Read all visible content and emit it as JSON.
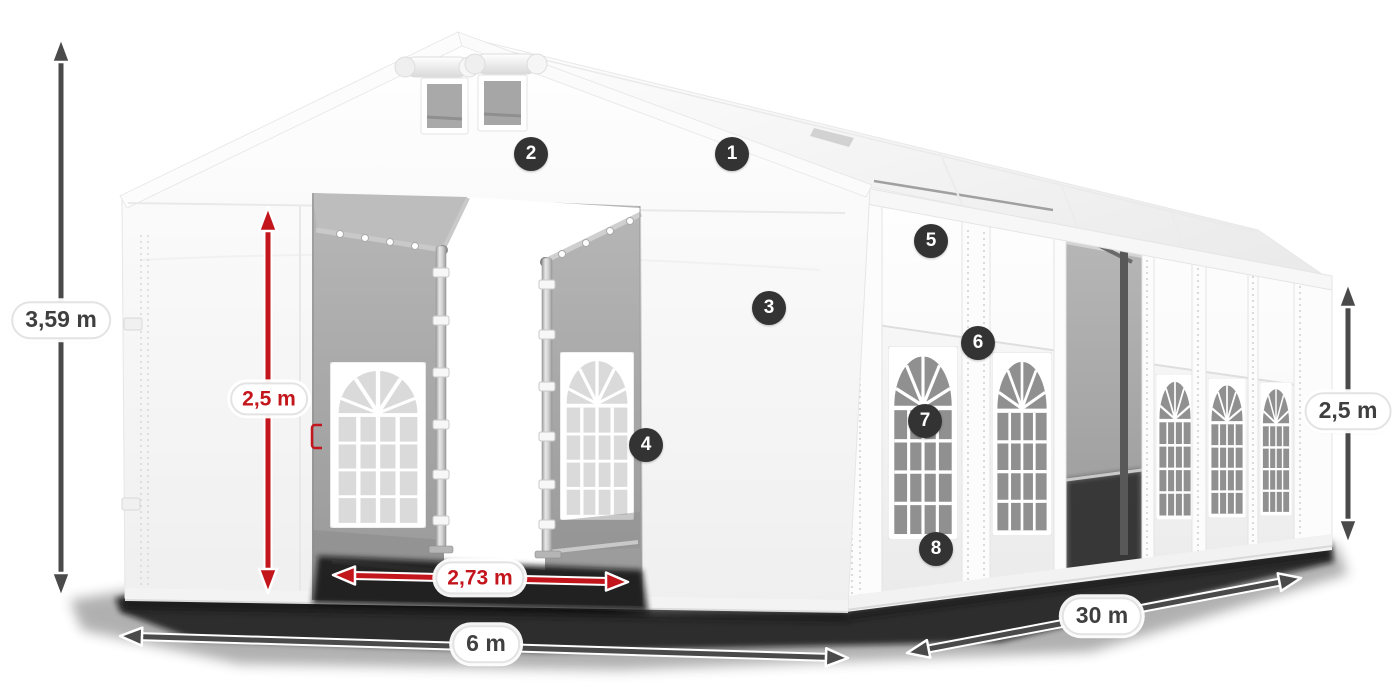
{
  "diagram": {
    "dimensions": {
      "total_height": "3,59 m",
      "entrance_height": "2,5 m",
      "entrance_width": "2,73 m",
      "width": "6 m",
      "length": "30 m",
      "side_wall_height": "2,5 m"
    },
    "feature_badges": [
      "1",
      "2",
      "3",
      "4",
      "5",
      "6",
      "7",
      "8"
    ],
    "colors": {
      "dimension_accent_red": "#c3151c",
      "dimension_arrow_gray": "#4a4a4a",
      "badge_background": "#333333",
      "badge_text": "#ffffff",
      "label_text": "#3f3f3f",
      "tent_white": "#ffffff",
      "interior_gray": "#a8a8a8",
      "background": "#ffffff"
    }
  }
}
